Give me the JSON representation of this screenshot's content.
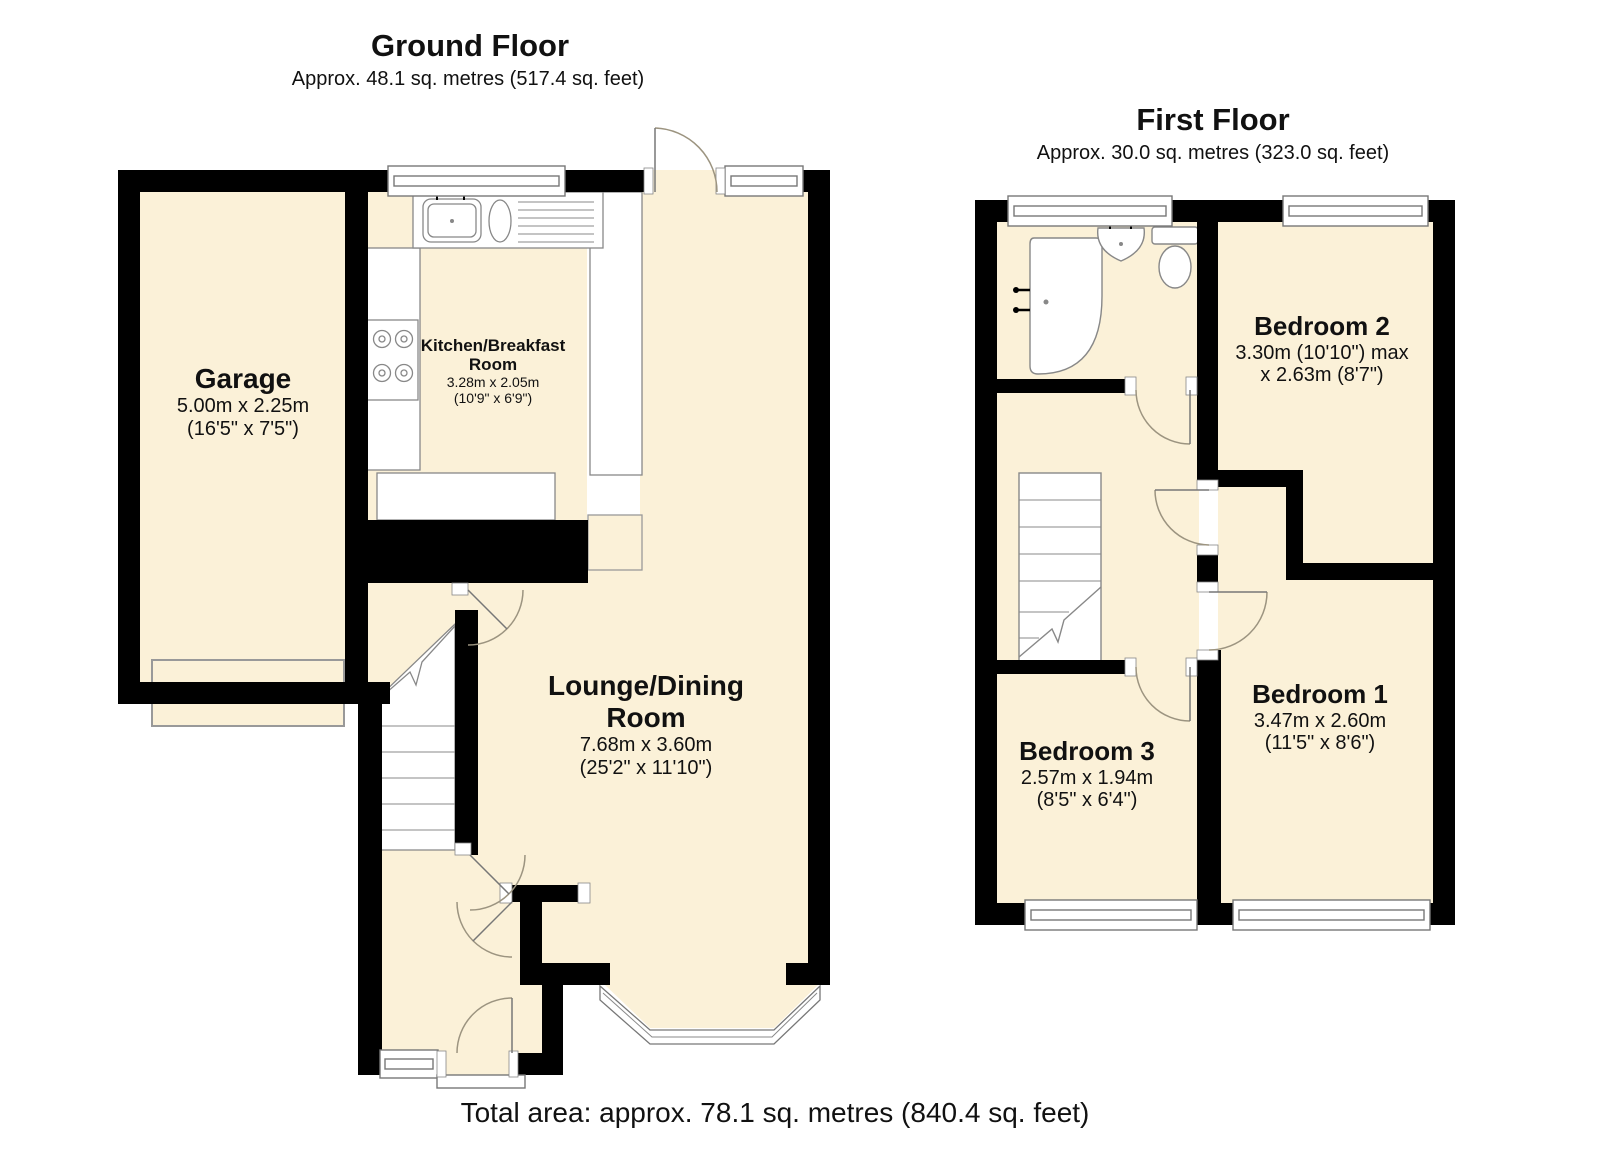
{
  "ground_floor": {
    "title": "Ground Floor",
    "subtitle": "Approx. 48.1 sq. metres (517.4 sq. feet)",
    "rooms": {
      "garage": {
        "name": "Garage",
        "size_metric": "5.00m x 2.25m",
        "size_imperial": "(16'5\" x 7'5\")"
      },
      "kitchen": {
        "name_line1": "Kitchen/Breakfast",
        "name_line2": "Room",
        "size_metric": "3.28m x 2.05m",
        "size_imperial": "(10'9\" x 6'9\")"
      },
      "lounge": {
        "name_line1": "Lounge/Dining",
        "name_line2": "Room",
        "size_metric": "7.68m x 3.60m",
        "size_imperial": "(25'2\" x 11'10\")"
      }
    }
  },
  "first_floor": {
    "title": "First Floor",
    "subtitle": "Approx. 30.0 sq. metres (323.0 sq. feet)",
    "rooms": {
      "bedroom2": {
        "name": "Bedroom 2",
        "size_metric": "3.30m (10'10\") max",
        "size_imperial": "x 2.63m (8'7\")"
      },
      "bedroom1": {
        "name": "Bedroom 1",
        "size_metric": "3.47m x 2.60m",
        "size_imperial": "(11'5\" x 8'6\")"
      },
      "bedroom3": {
        "name": "Bedroom 3",
        "size_metric": "2.57m x 1.94m",
        "size_imperial": "(8'5\" x 6'4\")"
      }
    }
  },
  "footer": {
    "total_area": "Total area: approx. 78.1 sq. metres (840.4 sq. feet)"
  },
  "colors": {
    "room_fill": "#FBF1D8",
    "wall": "#000000",
    "fixture_outline": "#888888",
    "door_arc": "#9C9480",
    "window_outline": "#777777"
  }
}
